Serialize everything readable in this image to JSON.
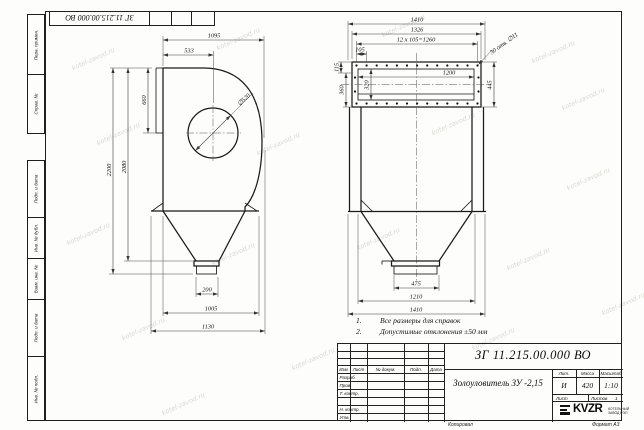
{
  "stamp": {
    "doc_number_rotated": "ЗГ 11.215.00.000 ВО"
  },
  "margin_columns": {
    "top": [
      "Перв. примен.",
      "Справ. №"
    ],
    "bottom": [
      "Подп. и дата",
      "Инв. № дубл.",
      "Взам. инв. №",
      "Подп. и дата",
      "Инв. № подл."
    ]
  },
  "notes": {
    "items": [
      {
        "num": "1.",
        "text": "Все размеры для справок"
      },
      {
        "num": "2.",
        "text": "Допустимые отклонения  ±50 мм"
      }
    ]
  },
  "side_view": {
    "dim_width_top": "1095",
    "dim_inlet_width": "533",
    "dim_inlet_height": "660",
    "dim_total_height": "2200",
    "dim_body_height": "2080",
    "dim_inlet_diameter": "∅520",
    "dim_outlet_width": "200",
    "dim_hopper_width": "1005",
    "dim_base_width": "1130"
  },
  "front_view": {
    "dim_width_top": "1410",
    "dim_flange_width": "1326",
    "dim_bolt_pattern": "12 х 105=1260",
    "dim_bolt_step": "105",
    "dim_holes_note": "30 отв. ∅11",
    "dim_opening_width": "1200",
    "dim_opening_height": "320",
    "dim_flange_height": "445",
    "dim_edge_offset": "115",
    "dim_inner_offset": "360",
    "dim_outlet_width": "475",
    "dim_support_span": "1210",
    "dim_width_bottom": "1410"
  },
  "title_block": {
    "doc_number": "ЗГ 11.215.00.000  ВО",
    "product_name": "Золоуловитель ЗУ -2,15",
    "header_cols": [
      "Изм.",
      "Лист",
      "№ докум.",
      "Подп.",
      "Дата"
    ],
    "row_labels": [
      "Разраб.",
      "Пров.",
      "Т. контр.",
      "Н. контр.",
      "Утв."
    ],
    "lit_header": "Лит.",
    "mass_header": "Масса",
    "scale_header": "Масштаб",
    "lit_value": "И",
    "mass_value": "420",
    "scale_value": "1:10",
    "sheet_label": "Лист",
    "sheets_label": "Листов",
    "sheets_value": "1",
    "logo_text": "KVZR",
    "logo_caption_line1": "КОТЕЛЬНЫЙ",
    "logo_caption_line2": "ЗАВОД РЭП",
    "copied_label": "Копировал",
    "format_label": "Формат А3"
  },
  "watermark": {
    "text": "kotel-zavod.ru"
  }
}
